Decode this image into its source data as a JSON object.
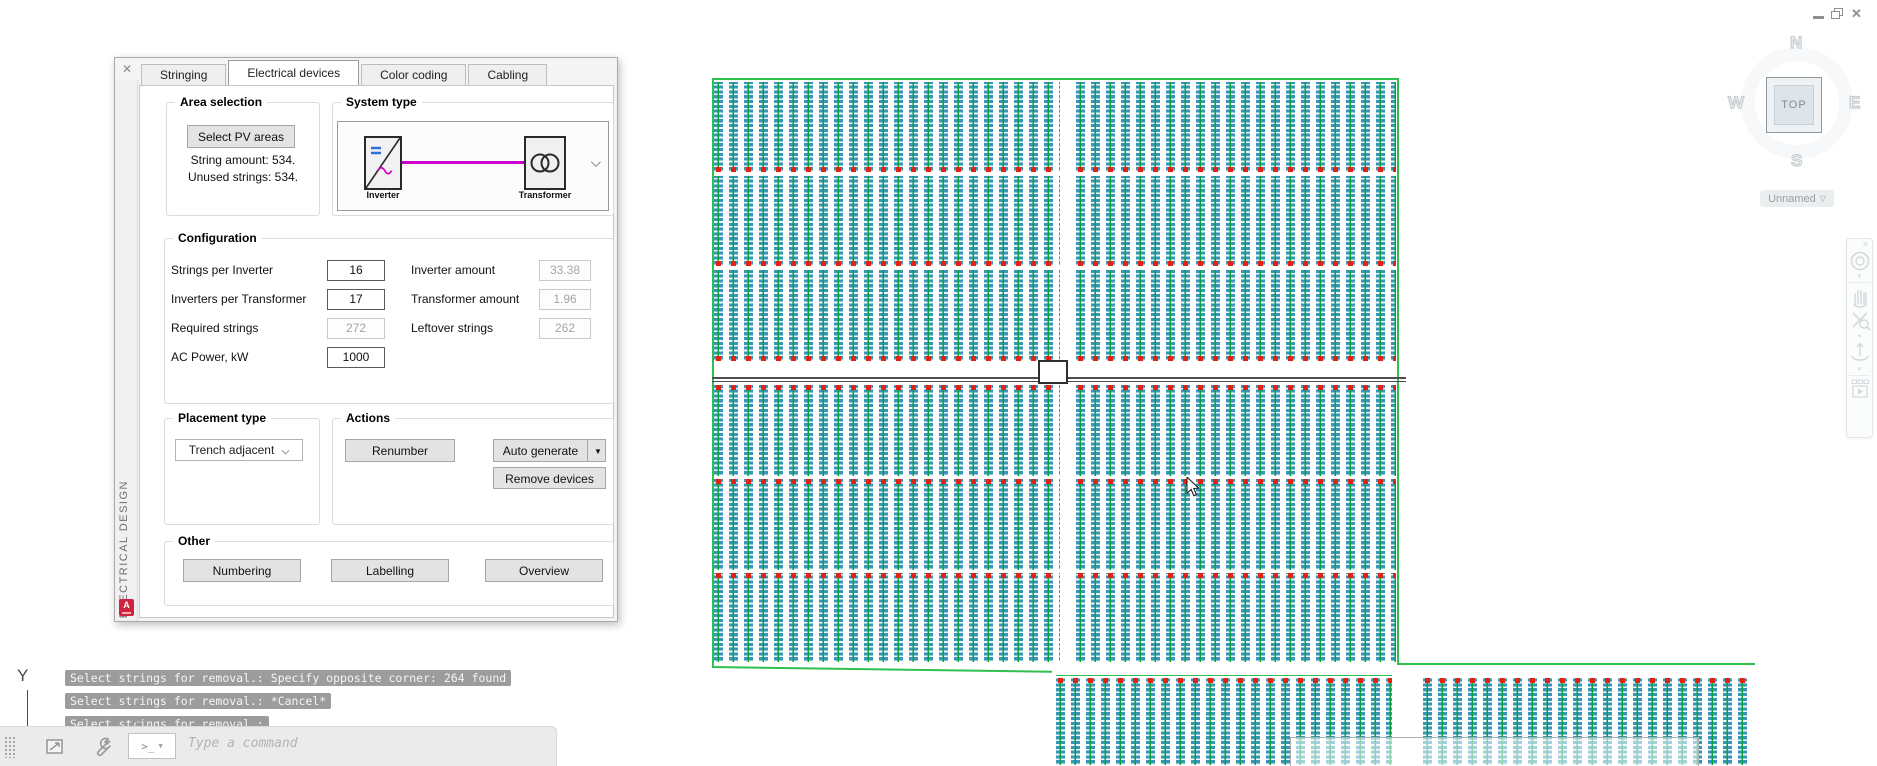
{
  "window": {
    "controls": [
      "minimize",
      "restore",
      "close"
    ]
  },
  "panel": {
    "close_glyph": "✕",
    "side_label": "ELECTRICAL DESIGN",
    "badge_letter": "A",
    "tabs": [
      {
        "label": "Stringing"
      },
      {
        "label": "Electrical devices"
      },
      {
        "label": "Color coding"
      },
      {
        "label": "Cabling"
      }
    ],
    "area_selection": {
      "title": "Area selection",
      "select_button": "Select PV areas",
      "string_amount": "String amount: 534.",
      "unused_strings": "Unused strings: 534."
    },
    "system_type": {
      "title": "System type",
      "inverter_label": "Inverter",
      "transformer_label": "Transformer"
    },
    "configuration": {
      "title": "Configuration",
      "fields": [
        {
          "label": "Strings per Inverter",
          "value": "16",
          "disabled": false
        },
        {
          "label": "Inverter amount",
          "value": "33.38",
          "disabled": true
        },
        {
          "label": "Inverters per Transformer",
          "value": "17",
          "disabled": false
        },
        {
          "label": "Transformer amount",
          "value": "1.96",
          "disabled": true
        },
        {
          "label": "Required strings",
          "value": "272",
          "disabled": true
        },
        {
          "label": "Leftover strings",
          "value": "262",
          "disabled": true
        },
        {
          "label": "AC Power, kW",
          "value": "1000",
          "disabled": false
        }
      ]
    },
    "placement": {
      "title": "Placement type",
      "value": "Trench adjacent"
    },
    "actions": {
      "title": "Actions",
      "renumber": "Renumber",
      "auto_generate": "Auto generate",
      "remove_devices": "Remove devices"
    },
    "other": {
      "title": "Other",
      "numbering": "Numbering",
      "labelling": "Labelling",
      "overview": "Overview"
    }
  },
  "viewcube": {
    "north": "N",
    "south": "S",
    "east": "E",
    "west": "W",
    "top": "TOP",
    "view_name": "Unnamed"
  },
  "command_line": {
    "history": [
      "Select strings for removal.: Specify opposite corner: 264 found",
      "Select strings for removal.: *Cancel*",
      "Select strings for removal.:"
    ],
    "prompt_glyph": ">_",
    "placeholder": "Type a command",
    "axis_label": "Y"
  },
  "drawing": {
    "colors": {
      "module_teal": "#3697bb",
      "string_green": "#0aa23c",
      "device_red": "#e02314",
      "boundary_green": "#2fbf4f",
      "trench_gray": "#4d4d4d",
      "link_magenta": "#cc00cc"
    },
    "rows": [
      [
        714,
        82,
        346,
        90,
        "bottom"
      ],
      [
        1076,
        82,
        320,
        90,
        "bottom"
      ],
      [
        714,
        176,
        346,
        90,
        "bottom"
      ],
      [
        1076,
        176,
        320,
        90,
        "bottom"
      ],
      [
        714,
        270,
        346,
        91,
        "bottom"
      ],
      [
        1076,
        270,
        320,
        91,
        "bottom"
      ],
      [
        714,
        385,
        346,
        91,
        "top"
      ],
      [
        1076,
        385,
        320,
        91,
        "top"
      ],
      [
        714,
        479,
        346,
        91,
        "top"
      ],
      [
        1076,
        479,
        320,
        91,
        "top"
      ],
      [
        714,
        573,
        346,
        89,
        "top"
      ],
      [
        1076,
        573,
        320,
        89,
        "top"
      ],
      [
        1056,
        678,
        336,
        87,
        "top"
      ],
      [
        1423,
        678,
        327,
        87,
        "top"
      ]
    ]
  }
}
